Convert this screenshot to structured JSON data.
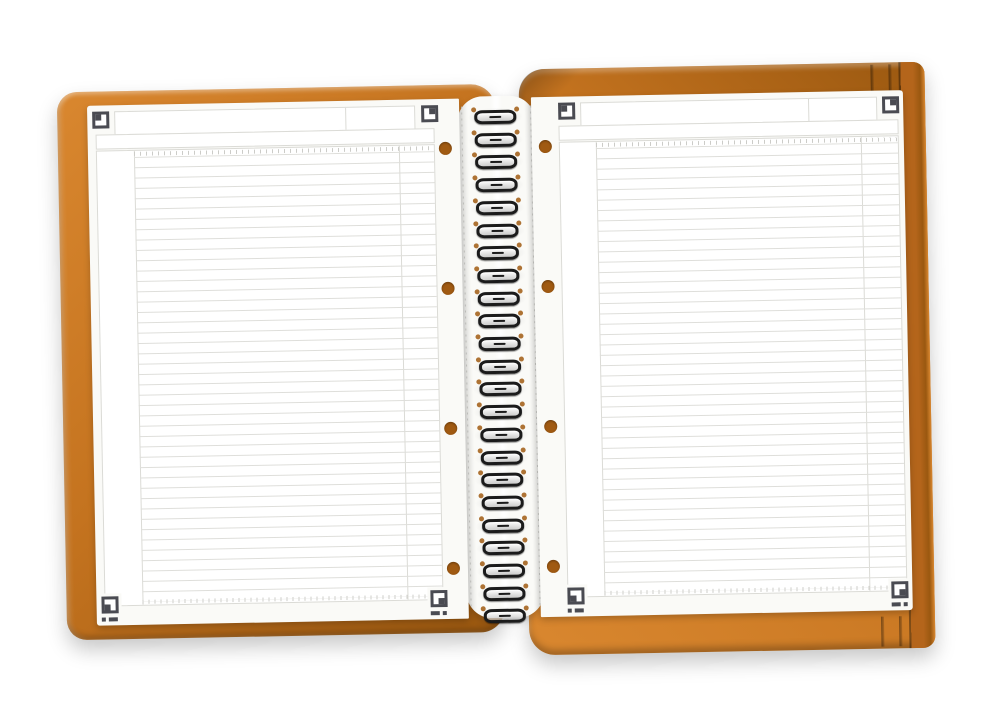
{
  "scene": {
    "type": "product-photo",
    "subject": "open wirebound notebook with orange polypropylene cover and blank ruled pages",
    "background": "#ffffff",
    "visible_text": ""
  },
  "colors": {
    "bg": "#ffffff",
    "cover_orange": "#C4731F",
    "cover_orange_light": "#D9872F",
    "cover_orange_dark": "#9A5810",
    "cover_edge": "#B4651B",
    "page": "#FAFAF7",
    "box_border": "#DBDBD6",
    "rule_line": "#DEDEDA",
    "tick": "#CCCCC8",
    "marker": "#4A4B52",
    "hole": "#A05A12",
    "coil": "#1B1B1B",
    "perforation": "#C6C6C2"
  },
  "counts": {
    "spiral_coils": 23,
    "punch_holes_per_page": 4,
    "ruled_lines_per_page": 43,
    "cover_slits": 2,
    "pages_visible": 2,
    "corner_markers_per_page": 4
  },
  "geometry": {
    "rule_spacing_px": 10.35,
    "coil_spacing_px": 22.7,
    "coil_start_y_px": 4,
    "hole_y_centers_px": [
      49,
      189,
      329,
      469
    ],
    "slit_x_px": [
      814,
      832
    ],
    "header_divider_percent": 77
  },
  "icons": {
    "corner_marker": "scan-corner-marker",
    "punch_hole": "punch-hole",
    "spiral_coil": "wire-coil"
  }
}
